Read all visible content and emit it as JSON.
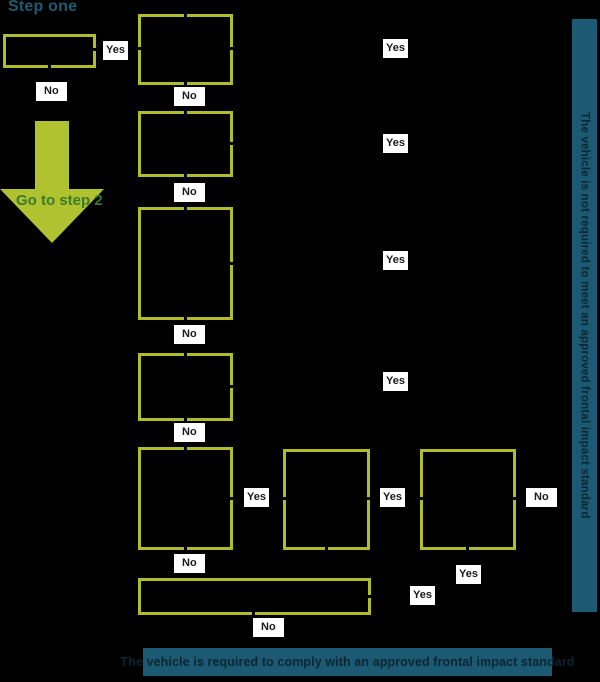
{
  "title": "Step one",
  "labels": {
    "yes": "Yes",
    "no": "No"
  },
  "arrow": {
    "label": "Go to step 2"
  },
  "right_bar": {
    "pre": "The vehicle is ",
    "bold": "not",
    "post": " required to meet an approved frontal impact standard"
  },
  "bottom_bar": {
    "pre": "The vehicle ",
    "bold": "is",
    "post": " required to comply with an approved frontal impact standard"
  },
  "colors": {
    "background": "#000000",
    "box_border": "#b1bc29",
    "arrow_fill": "#b1c230",
    "arrow_text": "#3a7a28",
    "title_text": "#1d5b73",
    "bar_background": "#1b5a72",
    "bar_text": "#0c2532",
    "label_background": "#ffffff",
    "label_text": "#1a1a1a"
  }
}
